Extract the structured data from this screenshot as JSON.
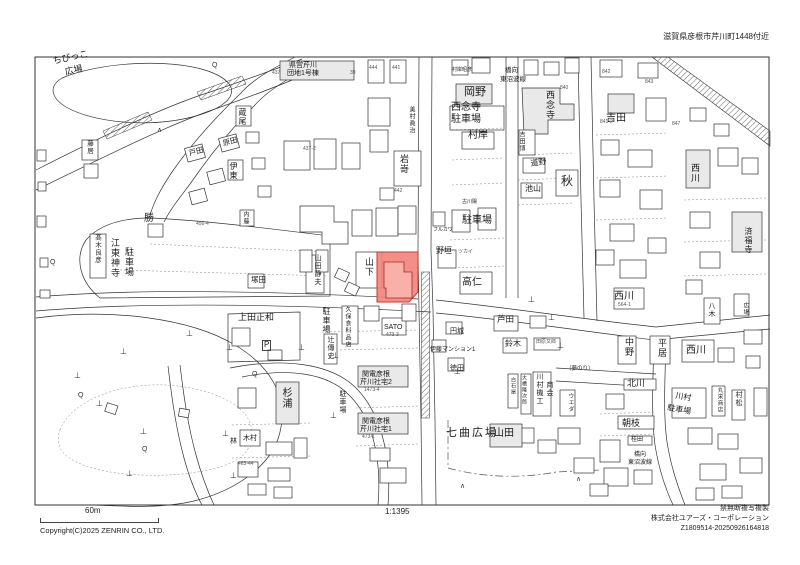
{
  "header": {
    "address_note": "滋賀県彦根市芹川町1448付近"
  },
  "footer": {
    "scale_bar_label": "60m",
    "scale_ratio": "1:1395",
    "copyright": "Copyright(C)2025 ZENRIN CO., LTD.",
    "rights_note": "禁無断複写複製",
    "publisher": "株式会社ユアーズ・コーポレーション",
    "serial": "Z1809514-20250926164818"
  },
  "map": {
    "highlight_color": "#f2837b",
    "highlight_stroke": "#c23b2e",
    "labels": [
      {
        "t": "ちびっこ",
        "x": 52,
        "y": 57,
        "o": "h",
        "s": 9,
        "r": -12
      },
      {
        "t": "広場",
        "x": 64,
        "y": 68,
        "o": "h",
        "s": 9,
        "r": -12
      },
      {
        "t": "県営芹川",
        "x": 289,
        "y": 62,
        "o": "h",
        "s": 7
      },
      {
        "t": "団地1号棟",
        "x": 287,
        "y": 70,
        "o": "h",
        "s": 7
      },
      {
        "t": "437",
        "x": 272,
        "y": 71,
        "o": "h",
        "s": 5,
        "c": "#555"
      },
      {
        "t": "39",
        "x": 350,
        "y": 71,
        "o": "h",
        "s": 5,
        "c": "#555"
      },
      {
        "t": "444",
        "x": 369,
        "y": 66,
        "o": "h",
        "s": 5,
        "c": "#555"
      },
      {
        "t": "441",
        "x": 392,
        "y": 66,
        "o": "h",
        "s": 5,
        "c": "#555"
      },
      {
        "t": "437-2",
        "x": 303,
        "y": 147,
        "o": "h",
        "s": 5,
        "c": "#555"
      },
      {
        "t": "美村眞治",
        "x": 408,
        "y": 106,
        "o": "v",
        "s": 6
      },
      {
        "t": "岩嵜",
        "x": 399,
        "y": 154,
        "o": "v",
        "s": 9
      },
      {
        "t": "442",
        "x": 394,
        "y": 189,
        "o": "h",
        "s": 5,
        "c": "#555"
      },
      {
        "t": "村岸昭彦",
        "x": 452,
        "y": 68,
        "o": "h",
        "s": 5
      },
      {
        "t": "岡野",
        "x": 464,
        "y": 87,
        "o": "h",
        "s": 11
      },
      {
        "t": "橋向",
        "x": 505,
        "y": 68,
        "o": "h",
        "s": 6.5
      },
      {
        "t": "東沼波線",
        "x": 500,
        "y": 77,
        "o": "h",
        "s": 6.5
      },
      {
        "t": "西念寺",
        "x": 451,
        "y": 103,
        "o": "h",
        "s": 10
      },
      {
        "t": "駐車場",
        "x": 451,
        "y": 115,
        "o": "h",
        "s": 10
      },
      {
        "t": "村岸",
        "x": 468,
        "y": 131,
        "o": "h",
        "s": 10
      },
      {
        "t": "西念寺",
        "x": 545,
        "y": 90,
        "o": "v",
        "s": 9
      },
      {
        "t": "吉田",
        "x": 606,
        "y": 114,
        "o": "h",
        "s": 10
      },
      {
        "t": "840",
        "x": 560,
        "y": 86,
        "o": "h",
        "s": 5,
        "c": "#555"
      },
      {
        "t": "842",
        "x": 602,
        "y": 70,
        "o": "h",
        "s": 5,
        "c": "#555"
      },
      {
        "t": "843",
        "x": 645,
        "y": 80,
        "o": "h",
        "s": 5,
        "c": "#555"
      },
      {
        "t": "847",
        "x": 672,
        "y": 122,
        "o": "h",
        "s": 5,
        "c": "#555"
      },
      {
        "t": "841-2",
        "x": 600,
        "y": 120,
        "o": "h",
        "s": 5,
        "c": "#555"
      },
      {
        "t": "吉田博",
        "x": 518,
        "y": 131,
        "o": "v",
        "s": 6
      },
      {
        "t": "道野",
        "x": 530,
        "y": 160,
        "o": "h",
        "s": 8,
        "r": -8
      },
      {
        "t": "池山",
        "x": 525,
        "y": 185,
        "o": "h",
        "s": 8
      },
      {
        "t": "秋",
        "x": 561,
        "y": 175,
        "o": "h",
        "s": 12
      },
      {
        "t": "西川",
        "x": 690,
        "y": 163,
        "o": "v",
        "s": 9
      },
      {
        "t": "済福寺",
        "x": 744,
        "y": 227,
        "o": "v",
        "s": 8
      },
      {
        "t": "西川",
        "x": 614,
        "y": 292,
        "o": "h",
        "s": 10
      },
      {
        "t": "564-1",
        "x": 618,
        "y": 303,
        "o": "h",
        "s": 5,
        "c": "#555"
      },
      {
        "t": "髙木良彦",
        "x": 93,
        "y": 234,
        "o": "v",
        "s": 6.5
      },
      {
        "t": "江東神寺",
        "x": 110,
        "y": 238,
        "o": "v",
        "s": 9
      },
      {
        "t": "駐車場",
        "x": 124,
        "y": 247,
        "o": "v",
        "s": 9
      },
      {
        "t": "勝",
        "x": 144,
        "y": 214,
        "o": "h",
        "s": 10
      },
      {
        "t": "藤居",
        "x": 85,
        "y": 140,
        "o": "v",
        "s": 6.5
      },
      {
        "t": "蔵尾",
        "x": 238,
        "y": 108,
        "o": "v",
        "s": 8
      },
      {
        "t": "戸田",
        "x": 188,
        "y": 150,
        "o": "h",
        "s": 7.5,
        "r": -15
      },
      {
        "t": "原田",
        "x": 222,
        "y": 140,
        "o": "h",
        "s": 7.5,
        "r": -15
      },
      {
        "t": "伊東",
        "x": 229,
        "y": 162,
        "o": "v",
        "s": 8
      },
      {
        "t": "内藤",
        "x": 242,
        "y": 211,
        "o": "v",
        "s": 6
      },
      {
        "t": "456-4",
        "x": 196,
        "y": 222,
        "o": "h",
        "s": 5,
        "c": "#555"
      },
      {
        "t": "塚田",
        "x": 251,
        "y": 276,
        "o": "h",
        "s": 7.5
      },
      {
        "t": "山田静夫",
        "x": 314,
        "y": 254,
        "o": "v",
        "s": 7
      },
      {
        "t": "山下",
        "x": 364,
        "y": 257,
        "o": "v",
        "s": 9
      },
      {
        "t": "古川陽",
        "x": 462,
        "y": 200,
        "o": "h",
        "s": 5
      },
      {
        "t": "フルカワ",
        "x": 433,
        "y": 228,
        "o": "h",
        "s": 5
      },
      {
        "t": "駐車場",
        "x": 462,
        "y": 216,
        "o": "h",
        "s": 10
      },
      {
        "t": "野垣",
        "x": 436,
        "y": 247,
        "o": "h",
        "s": 8
      },
      {
        "t": "ツカイ",
        "x": 458,
        "y": 250,
        "o": "h",
        "s": 5,
        "c": "#555"
      },
      {
        "t": "高仁",
        "x": 462,
        "y": 278,
        "o": "h",
        "s": 10
      },
      {
        "t": "上田正和",
        "x": 238,
        "y": 313,
        "o": "h",
        "s": 9
      },
      {
        "t": "P",
        "x": 262,
        "y": 340,
        "o": "h",
        "s": 8,
        "box": true
      },
      {
        "t": "駐車場",
        "x": 322,
        "y": 307,
        "o": "v",
        "s": 8
      },
      {
        "t": "久保食料品店",
        "x": 344,
        "y": 306,
        "o": "v",
        "s": 6
      },
      {
        "t": "SATO",
        "x": 384,
        "y": 324,
        "o": "h",
        "s": 7
      },
      {
        "t": "473-3",
        "x": 386,
        "y": 333,
        "o": "h",
        "s": 5,
        "c": "#555"
      },
      {
        "t": "辻傳史",
        "x": 327,
        "y": 336,
        "o": "v",
        "s": 7
      },
      {
        "t": "関電彦根",
        "x": 362,
        "y": 371,
        "o": "h",
        "s": 7
      },
      {
        "t": "芹川社宅2",
        "x": 360,
        "y": 379,
        "o": "h",
        "s": 7
      },
      {
        "t": "1473-4",
        "x": 364,
        "y": 388,
        "o": "h",
        "s": 5,
        "c": "#555"
      },
      {
        "t": "駐車場",
        "x": 339,
        "y": 390,
        "o": "v",
        "s": 7
      },
      {
        "t": "関電彦根",
        "x": 362,
        "y": 418,
        "o": "h",
        "s": 7
      },
      {
        "t": "芹川社宅1",
        "x": 360,
        "y": 426,
        "o": "h",
        "s": 7
      },
      {
        "t": "473-1",
        "x": 362,
        "y": 435,
        "o": "h",
        "s": 5,
        "c": "#555"
      },
      {
        "t": "杉浦",
        "x": 280,
        "y": 387,
        "o": "v",
        "s": 10
      },
      {
        "t": "木村",
        "x": 243,
        "y": 435,
        "o": "h",
        "s": 7
      },
      {
        "t": "林",
        "x": 230,
        "y": 438,
        "o": "h",
        "s": 7
      },
      {
        "t": "463-44",
        "x": 238,
        "y": 462,
        "o": "h",
        "s": 5,
        "c": "#555"
      },
      {
        "t": "芦田",
        "x": 497,
        "y": 315,
        "o": "h",
        "s": 8.5
      },
      {
        "t": "鈴木",
        "x": 505,
        "y": 340,
        "o": "h",
        "s": 8
      },
      {
        "t": "田原又郎",
        "x": 536,
        "y": 340,
        "o": "h",
        "s": 5,
        "c": "#555"
      },
      {
        "t": "中野",
        "x": 624,
        "y": 337,
        "o": "v",
        "s": 9
      },
      {
        "t": "平居",
        "x": 657,
        "y": 338,
        "o": "v",
        "s": 9
      },
      {
        "t": "西川",
        "x": 686,
        "y": 346,
        "o": "h",
        "s": 10
      },
      {
        "t": "北川",
        "x": 627,
        "y": 379,
        "o": "h",
        "s": 9
      },
      {
        "t": "朝枝",
        "x": 622,
        "y": 419,
        "o": "h",
        "s": 9
      },
      {
        "t": "桂田",
        "x": 631,
        "y": 437,
        "o": "h",
        "s": 6
      },
      {
        "t": "橋向",
        "x": 634,
        "y": 452,
        "o": "h",
        "s": 6
      },
      {
        "t": "東沼波線",
        "x": 628,
        "y": 460,
        "o": "h",
        "s": 6
      },
      {
        "t": "川村",
        "x": 676,
        "y": 392,
        "o": "h",
        "s": 8,
        "r": 10
      },
      {
        "t": "駐車場",
        "x": 668,
        "y": 404,
        "o": "h",
        "s": 8,
        "r": 10
      },
      {
        "t": "丸栄商店",
        "x": 716,
        "y": 387,
        "o": "v",
        "s": 5.5
      },
      {
        "t": "村松",
        "x": 735,
        "y": 391,
        "o": "v",
        "s": 7
      },
      {
        "t": "七曲広場",
        "x": 446,
        "y": 428,
        "o": "h",
        "s": 11,
        "ls": 2
      },
      {
        "t": "山田",
        "x": 494,
        "y": 429,
        "o": "h",
        "s": 10
      },
      {
        "t": "川村機工",
        "x": 536,
        "y": 373,
        "o": "v",
        "s": 7
      },
      {
        "t": "商会",
        "x": 546,
        "y": 381,
        "o": "v",
        "s": 7
      },
      {
        "t": "大橋隆次郎",
        "x": 521,
        "y": 375,
        "o": "v",
        "s": 5
      },
      {
        "t": "白石屋",
        "x": 510,
        "y": 377,
        "o": "v",
        "s": 5
      },
      {
        "t": "伊藤マンション1",
        "x": 430,
        "y": 347,
        "o": "h",
        "s": 6
      },
      {
        "t": "円城",
        "x": 450,
        "y": 328,
        "o": "h",
        "s": 7
      },
      {
        "t": "徳田",
        "x": 450,
        "y": 365,
        "o": "h",
        "s": 7
      },
      {
        "t": "ウエダ",
        "x": 567,
        "y": 393,
        "o": "v",
        "s": 5.5
      },
      {
        "t": "（夢のり）",
        "x": 566,
        "y": 367,
        "o": "h",
        "s": 5.5
      },
      {
        "t": "八木",
        "x": 708,
        "y": 302,
        "o": "v",
        "s": 7
      },
      {
        "t": "広場",
        "x": 742,
        "y": 302,
        "o": "v",
        "s": 6
      }
    ],
    "symbols": [
      {
        "glyph": "⊥",
        "name": "tree-symbol",
        "size": 8,
        "pts": [
          [
            186,
            330
          ],
          [
            226,
            344
          ],
          [
            298,
            344
          ],
          [
            332,
            352
          ],
          [
            120,
            348
          ],
          [
            74,
            372
          ],
          [
            96,
            400
          ],
          [
            140,
            428
          ],
          [
            222,
            430
          ],
          [
            330,
            412
          ],
          [
            454,
            368
          ],
          [
            528,
            296
          ],
          [
            548,
            314
          ],
          [
            557,
            342
          ],
          [
            126,
            470
          ],
          [
            230,
            472
          ]
        ]
      },
      {
        "glyph": "Q",
        "name": "shrub-symbol",
        "size": 7,
        "pts": [
          [
            212,
            62
          ],
          [
            50,
            259
          ],
          [
            78,
            392
          ],
          [
            142,
            446
          ],
          [
            252,
            371
          ]
        ]
      },
      {
        "glyph": "∧",
        "name": "gate-symbol",
        "size": 7,
        "pts": [
          [
            157,
            127
          ],
          [
            460,
            483
          ],
          [
            576,
            476
          ]
        ]
      }
    ]
  }
}
